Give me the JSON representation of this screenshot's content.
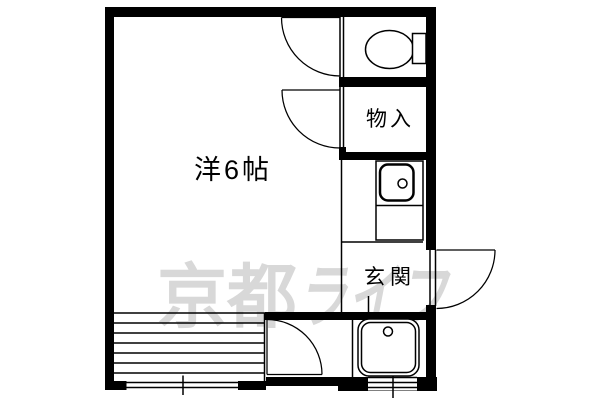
{
  "document": {
    "type": "apartment-floor-plan",
    "background_color": "#ffffff",
    "wall_color": "#000000"
  },
  "rooms": {
    "main_room_label": "洋6帖",
    "storage_label": "物入",
    "entrance_label": "玄関"
  },
  "watermark": {
    "text": "京都ライフ",
    "part_kanji": "京都",
    "part_kana": "ライフ",
    "color": "#d8d8d8"
  },
  "fixtures": {
    "toilet": "toilet-icon",
    "kitchen_sink": "kitchen-sink-icon",
    "bath_unit": "bath-unit-icon",
    "doors": "door-swing-icon",
    "windows": "window-icon",
    "balcony": "balcony-stripes"
  }
}
